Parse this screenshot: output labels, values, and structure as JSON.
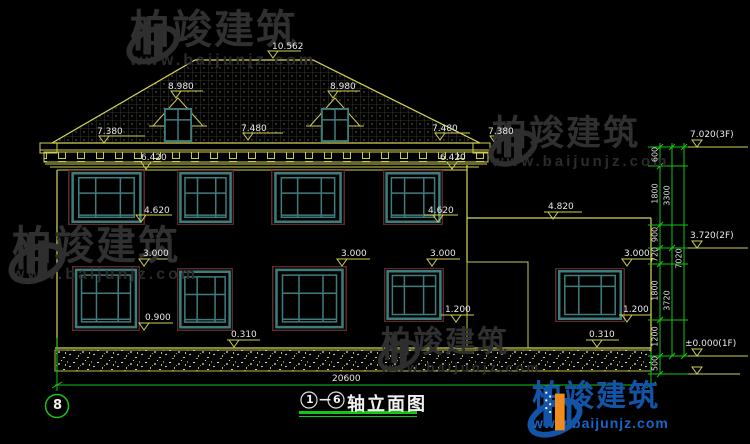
{
  "watermark": {
    "brand": "柏竣建筑",
    "site": "www.baijunjz.com"
  },
  "logo": {
    "brand": "柏竣建筑",
    "site": "www.baijunjz.com"
  },
  "sheet": {
    "number": "8"
  },
  "title": {
    "axis_from": "1",
    "separator": "—",
    "axis_to": "6",
    "label": "轴立面图"
  },
  "levels": {
    "ridge": "10.562",
    "dormer_left": "8.980",
    "dormer_right": "8.980",
    "eave_outer_left": "7.380",
    "eave_inner_left": "7.480",
    "eave_inner_right": "7.480",
    "eave_outer_right": "7.380",
    "cornice_left": "6.420",
    "cornice_right": "6.420",
    "sill2f_left": "4.620",
    "sill2f_right": "4.620",
    "annex_roof": "4.820",
    "win1f_tops": [
      "3.000",
      "3.000",
      "3.000",
      "3.000"
    ],
    "sill1f": [
      "1.200",
      "1.200"
    ],
    "sill1f_left": "0.900",
    "plinth": [
      "0.310",
      "0.310"
    ],
    "floor3": "7.020(3F)",
    "floor2": "3.720(2F)",
    "floor1": "±0.000(1F)"
  },
  "dims": {
    "total_width": "20600",
    "chain_inner": [
      "600",
      "1800",
      "900",
      "720",
      "1800",
      "1200",
      "500"
    ],
    "chain_mid": [
      "3300",
      "3720"
    ],
    "chain_outer": "7020"
  },
  "colors": {
    "line_yellow": "#cfcf52",
    "dim_green": "#17c517",
    "window_teal": "#3f7d7d",
    "window_trim": "#5d2b2b",
    "logo_blue": "#1254a8",
    "logo_orange": "#f08b1e"
  }
}
